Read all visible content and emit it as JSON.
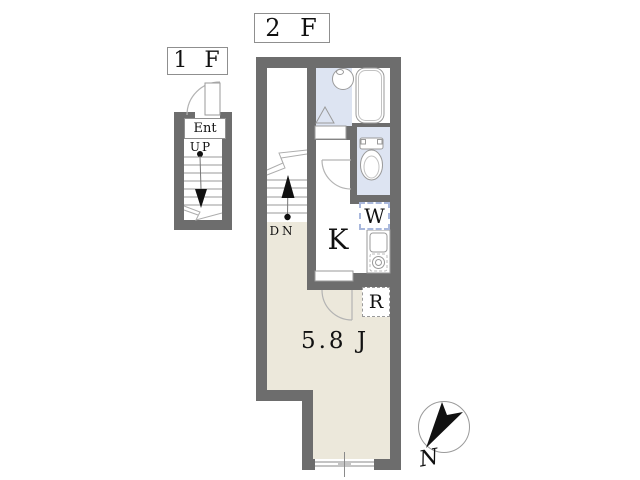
{
  "floors": {
    "f2": {
      "label": "2 F"
    },
    "f1": {
      "label": "1 F"
    }
  },
  "first_floor": {
    "entrance_label": "Ent",
    "stair_direction": "UP"
  },
  "second_floor": {
    "stair_direction": "DN",
    "kitchen_label": "K",
    "washer_label": "W",
    "fridge_label": "R",
    "room_area_label": "5.8 J"
  },
  "compass": {
    "north_label": "N"
  },
  "colors": {
    "wall": "#6d6d6d",
    "floor": "#ece8db",
    "wet": "#dde4f2",
    "line": "#9a9a9a",
    "arc": "#b3b3b3",
    "ink": "#111111",
    "boxborder": "#8f8f8f",
    "washerborder": "#a9b8dc"
  }
}
